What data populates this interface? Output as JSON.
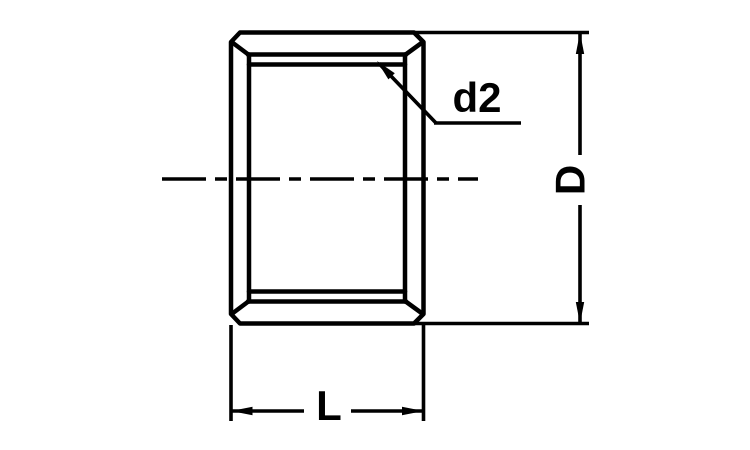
{
  "diagram": {
    "labels": {
      "inner_diameter": "d2",
      "outer_diameter": "D",
      "length": "L"
    },
    "colors": {
      "line": "#000000",
      "background": "#ffffff"
    }
  }
}
